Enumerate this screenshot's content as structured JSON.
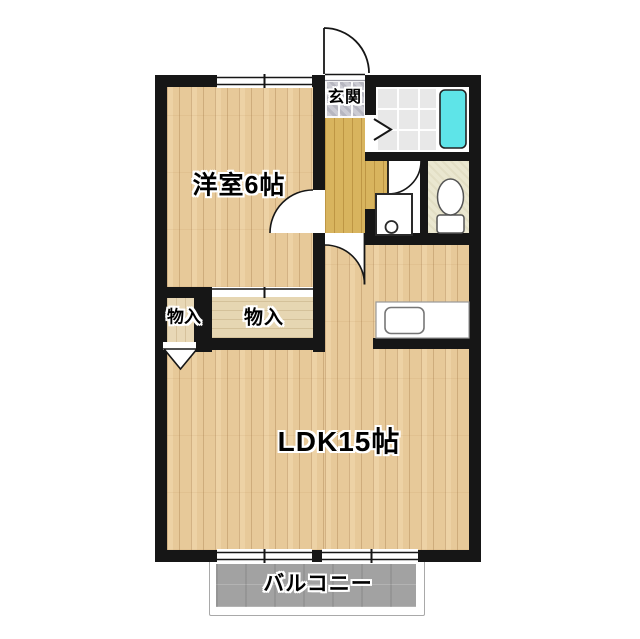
{
  "floorplan": {
    "labels": {
      "entrance": "玄関",
      "western_room": "洋室6帖",
      "closet_left": "物入",
      "closet_right": "物入",
      "ldk": "LDK15帖",
      "balcony": "バルコニー"
    },
    "colors": {
      "wall": "#161616",
      "wood_floor": "#e7c999",
      "hallway_floor": "#d8b45e",
      "entrance_tile": "#cbcbd3",
      "closet_floor": "#e8d8b6",
      "bathroom_tile": "#e8e8e8",
      "toilet_floor": "#eae7d0",
      "bathtub": "#5ee4e8",
      "balcony_floor": "#a2a2a2"
    },
    "fixtures": [
      "bathtub",
      "toilet",
      "washing-machine-pan",
      "kitchen-sink",
      "entrance-door",
      "room-door",
      "ldk-door",
      "washroom-door",
      "bifold-door",
      "closet-folding-door",
      "window"
    ]
  }
}
